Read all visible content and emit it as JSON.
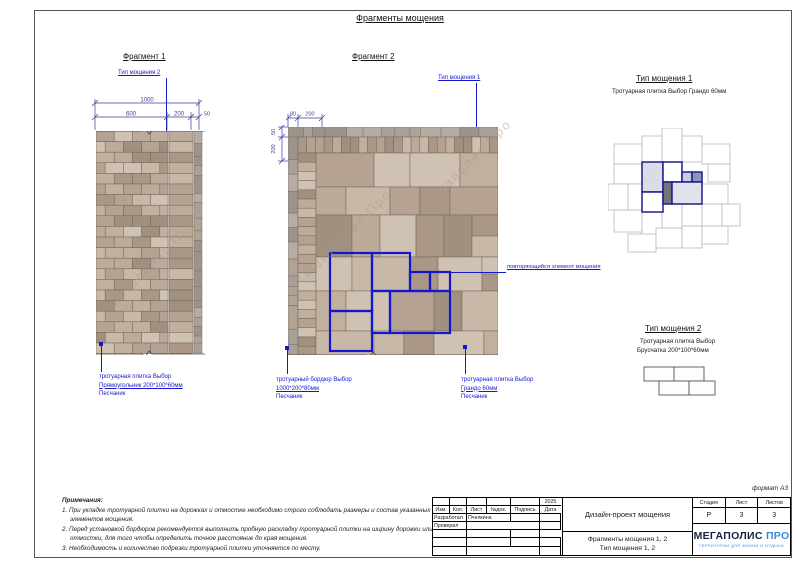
{
  "page": {
    "title": "Фрагменты мощения",
    "format_label": "формат А3",
    "watermark": "Мегаполис Про"
  },
  "fragment1": {
    "title": "Фрагмент 1",
    "type_label": "Тип мощения 2",
    "dims": {
      "total": "1000",
      "d1": "600",
      "d2": "200",
      "d3": "50"
    },
    "note": {
      "line1": "тротуарная плитка Выбор",
      "line2": "Прямоугольник 200*100*60мм",
      "line3": "Песчаник"
    }
  },
  "fragment2": {
    "title": "Фрагмент 2",
    "type_label": "Тип мощения 1",
    "dims": {
      "top1": "80",
      "top2": "200",
      "left1": "50",
      "left2": "200"
    },
    "repeat_label": "повторяющийся элемент мощения",
    "note_border": {
      "line1": "тротуарный бордюр Выбор",
      "line2": "1000*200*80мм",
      "line3": "Песчаник"
    },
    "note_tile": {
      "line1": "тротуарная плитка Выбор",
      "line2": "Грандо 60мм",
      "line3": "Песчаник"
    }
  },
  "type1": {
    "title": "Тип мощения 1",
    "subtitle": "Тротуарная плитка Выбор Грандо 60мм"
  },
  "type2": {
    "title": "Тип мощения 2",
    "line1": "Тротуарная плитка Выбор",
    "line2": "Брусчатка 200*100*60мм"
  },
  "notes": {
    "heading": "Примечания:",
    "items": [
      "1. При укладке тротуарной плитки на дорожках и отмостке необходимо строго соблюдать размеры и состав указанных элементов мощения.",
      "2. Перед установкой бордюров рекомендуется выполнить пробную раскладку тротуарной плитки на ширину дорожки или отмостки, для того чтобы определить точное расстояние до края мощения.",
      "3. Необходимость и количество подрезки тротуарной плитки уточняется по месту."
    ]
  },
  "titleblock": {
    "columns": [
      "Изм.",
      "Кол.",
      "Лист",
      "№док.",
      "Подпись",
      "Дата"
    ],
    "year": "2025",
    "row_developed": {
      "label": "Разработал",
      "name": "Пчелкина"
    },
    "row_checked": {
      "label": "Проверил",
      "name": ""
    },
    "project": "Дизайн-проект мощения",
    "sheet_title_1": "Фрагменты мощения 1, 2",
    "sheet_title_2": "Тип мощения 1, 2",
    "stage": {
      "label": "Стадия",
      "value": "Р"
    },
    "sheet": {
      "label": "Лист",
      "value": "3"
    },
    "sheets": {
      "label": "Листов",
      "value": "3"
    },
    "logo": {
      "name1": "МЕГАПОЛИС",
      "name2": "ПРО",
      "tagline": "ТЕРРИТОРИИ ДЛЯ ЖИЗНИ И ОТДЫХА"
    }
  },
  "colors": {
    "annotation_blue": "#1717cf",
    "dim_navy": "#3c3c9a",
    "element_blue": "#1414d2",
    "logo_navy": "#17233f",
    "logo_blue": "#3a8ad8",
    "paving_palette": [
      "#bcab9a",
      "#c8b8a8",
      "#ab9785",
      "#b5a292",
      "#cfc2b2",
      "#a09080",
      "#c2b09e"
    ],
    "rough_palette": [
      "#a8a099",
      "#b5ada4",
      "#9c948c",
      "#b0a394"
    ]
  }
}
